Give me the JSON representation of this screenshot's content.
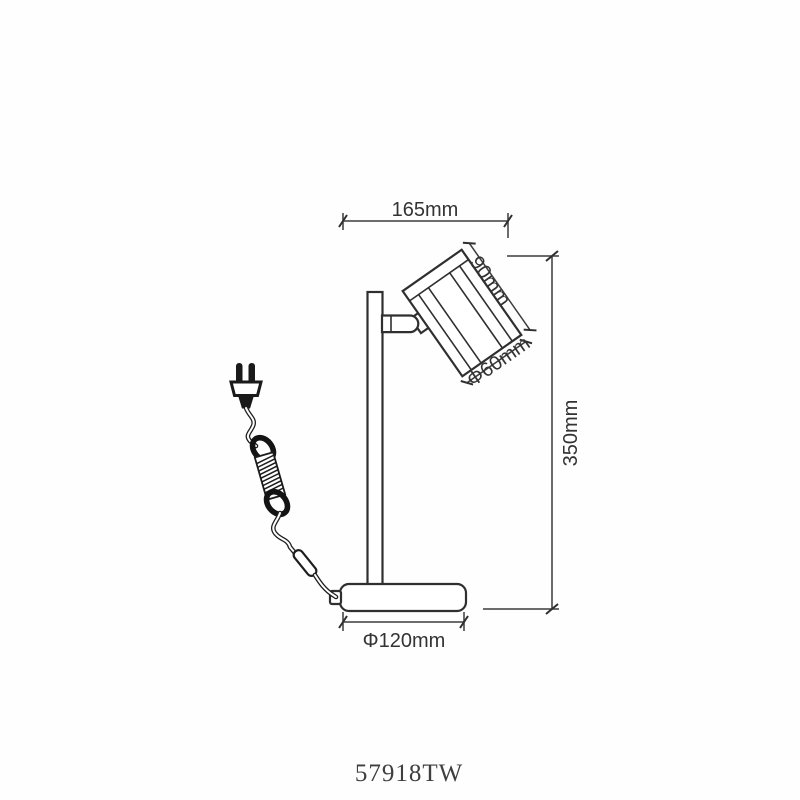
{
  "drawing": {
    "dimensions": {
      "width": "165mm",
      "height": "350mm",
      "head_length": "90mm",
      "head_diameter": "Φ60mm",
      "base_diameter": "Φ120mm"
    },
    "model_number": "57918TW",
    "colors": {
      "line": "#2f2f2f",
      "dimension_text": "#333333",
      "model_text": "#3f3f3f",
      "background": "#ffffff"
    }
  }
}
